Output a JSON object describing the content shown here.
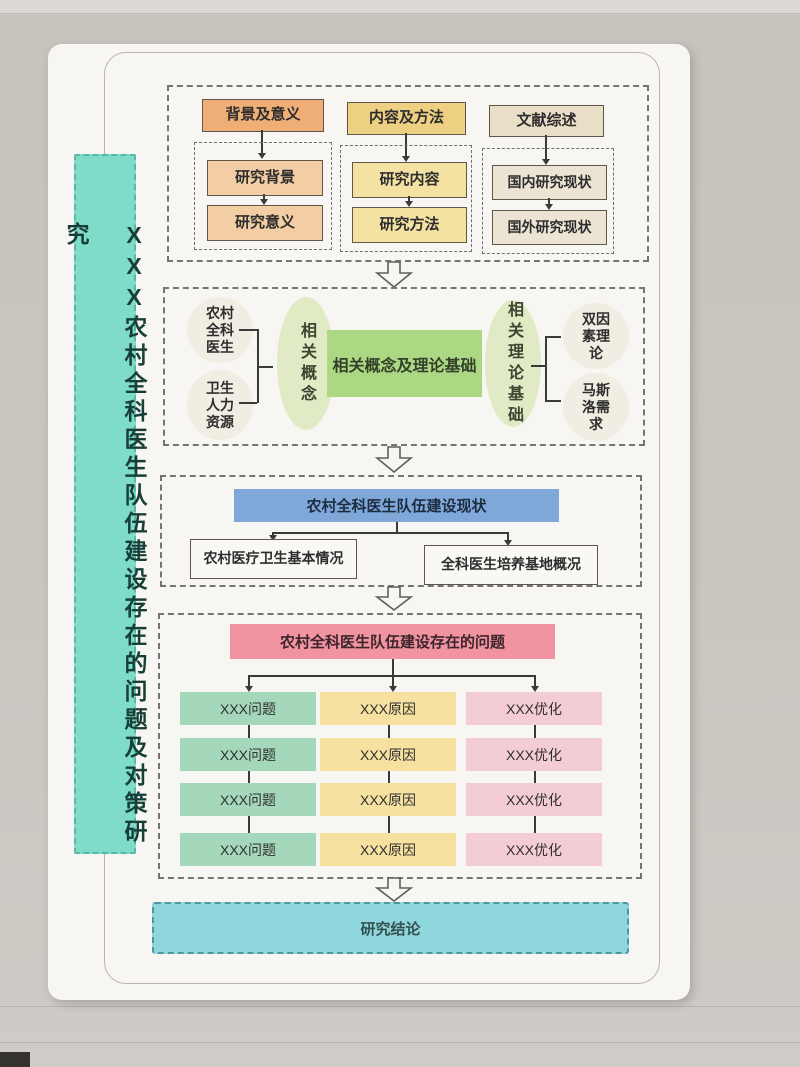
{
  "banner": {
    "title": "XXX农村全科医生队伍建设存在的问题及对策研究"
  },
  "section1": {
    "columns": [
      {
        "header": "背景及意义",
        "children": [
          "研究背景",
          "研究意义"
        ]
      },
      {
        "header": "内容及方法",
        "children": [
          "研究内容",
          "研究方法"
        ]
      },
      {
        "header": "文献综述",
        "children": [
          "国内研究现状",
          "国外研究现状"
        ]
      }
    ]
  },
  "section2": {
    "left_items": [
      "农村全科医生",
      "卫生人力资源"
    ],
    "left_hub": "相关概念",
    "center": "相关概念及理论基础",
    "right_hub": "相关理论基础",
    "right_items": [
      "双因素理论",
      "马斯洛需求"
    ]
  },
  "section3": {
    "header": "农村全科医生队伍建设现状",
    "children": [
      "农村医疗卫生基本情况",
      "全科医生培养基地概况"
    ]
  },
  "section4": {
    "header": "农村全科医生队伍建设存在的问题",
    "columns": [
      {
        "items": [
          "XXX问题",
          "XXX问题",
          "XXX问题",
          "XXX问题"
        ]
      },
      {
        "items": [
          "XXX原因",
          "XXX原因",
          "XXX原因",
          "XXX原因"
        ]
      },
      {
        "items": [
          "XXX优化",
          "XXX优化",
          "XXX优化",
          "XXX优化"
        ]
      }
    ]
  },
  "conclusion": {
    "label": "研究结论"
  },
  "colors": {
    "banner_teal": "#7edcc9",
    "intro_orange": "#f0ae77",
    "intro_orange_light": "#f3cda4",
    "intro_yellow": "#eed083",
    "intro_yellow_light": "#f3e2a1",
    "intro_beige": "#e9dfc7",
    "intro_beige_light": "#ebe4d3",
    "theory_green": "#acd884",
    "theory_green_light": "#e0ebc6",
    "status_blue": "#7fa8d8",
    "problem_pink": "#f193a0",
    "problem_green": "#a5d8bb",
    "cause_yellow": "#f7e1a0",
    "optimize_pink": "#f3cdd3",
    "conclusion_cyan": "#8dd7dd"
  }
}
